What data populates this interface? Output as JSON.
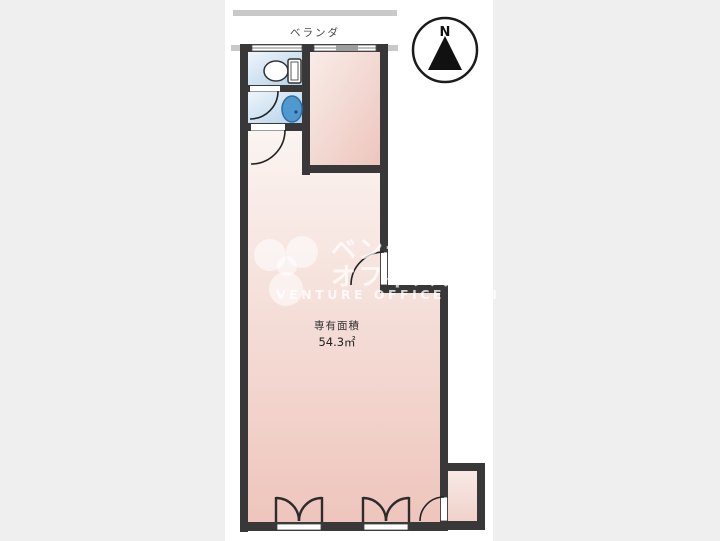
{
  "plan": {
    "balcony_label": "ベランダ",
    "compass_north": "N",
    "area_label": "専有面積",
    "area_value": "54.3㎡"
  },
  "watermark": {
    "jp_line1": "ベンチャー",
    "jp_line2": "オフィスナビ",
    "en_line": "VENTURE OFFICE NAVI"
  },
  "colors": {
    "page_background": "#efefef",
    "paper": "#ffffff",
    "wall": "#383838",
    "room_pink_top": "#fbf4f1",
    "room_pink_bottom": "#eec5bc",
    "wet_blue_light": "#eef5fb",
    "wet_blue_dark": "#b3d1e8",
    "sink_blue": "#4f98d0",
    "railing_gray": "#c9c9c9",
    "watermark_white": "rgba(255,255,255,0.75)"
  }
}
